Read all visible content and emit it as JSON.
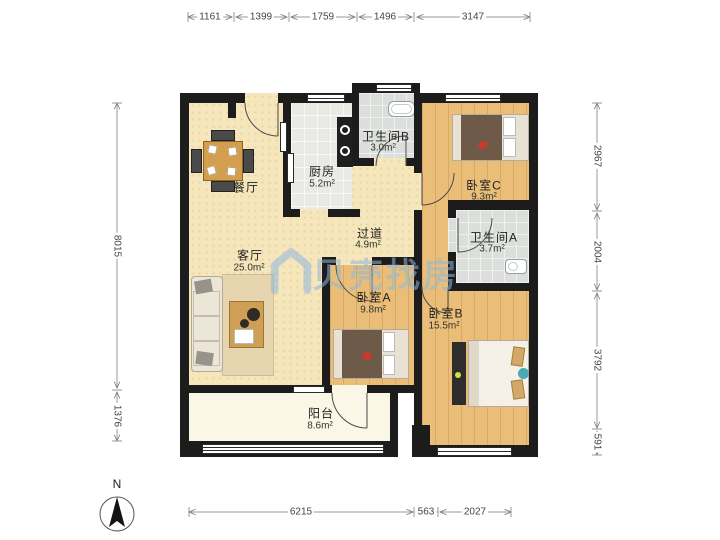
{
  "watermark": {
    "text": "贝壳找房",
    "color": "#8fb7dd"
  },
  "compass": {
    "label": "N"
  },
  "rooms": {
    "dining": {
      "name": "餐厅",
      "area": ""
    },
    "kitchen": {
      "name": "厨房",
      "area": "5.2m²"
    },
    "bathB": {
      "name": "卫生间B",
      "area": "3.0m²"
    },
    "bedC": {
      "name": "卧室C",
      "area": "9.3m²"
    },
    "hallway": {
      "name": "过道",
      "area": "4.9m²"
    },
    "bathA": {
      "name": "卫生间A",
      "area": "3.7m²"
    },
    "living": {
      "name": "客厅",
      "area": "25.0m²"
    },
    "bedA": {
      "name": "卧室A",
      "area": "9.8m²"
    },
    "bedB": {
      "name": "卧室B",
      "area": "15.5m²"
    },
    "balcony": {
      "name": "阳台",
      "area": "8.6m²"
    }
  },
  "dimensions": {
    "top": [
      "1161",
      "1399",
      "1759",
      "1496",
      "3147"
    ],
    "left": [
      "8015",
      "1376"
    ],
    "right": [
      "2967",
      "2004",
      "3792",
      "591"
    ],
    "bottom": [
      "6215",
      "563",
      "2027"
    ]
  }
}
